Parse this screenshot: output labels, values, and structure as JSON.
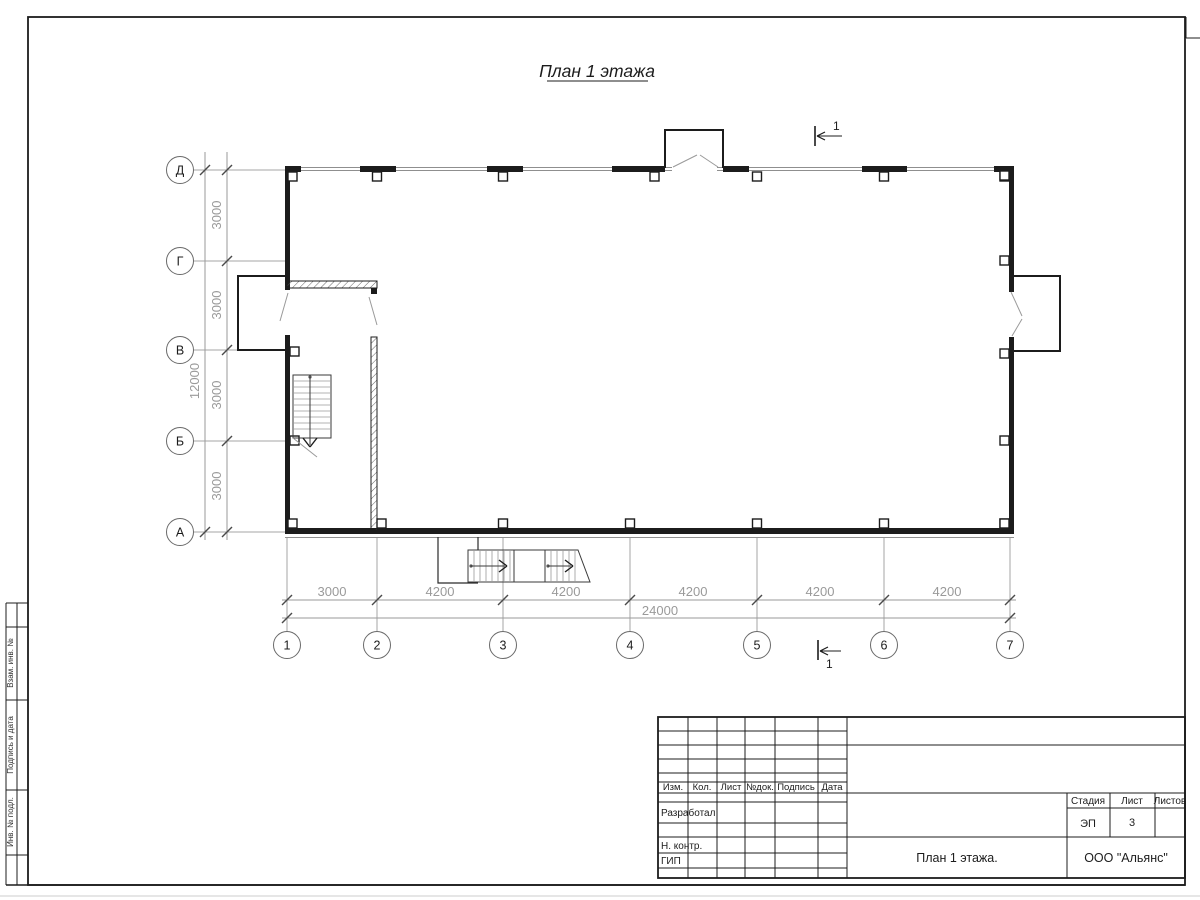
{
  "page": {
    "title_text": "План 1 этажа"
  },
  "axes": {
    "rows": [
      {
        "label": "Д"
      },
      {
        "label": "Г"
      },
      {
        "label": "В"
      },
      {
        "label": "Б"
      },
      {
        "label": "А"
      }
    ],
    "cols": [
      {
        "label": "1"
      },
      {
        "label": "2"
      },
      {
        "label": "3"
      },
      {
        "label": "4"
      },
      {
        "label": "5"
      },
      {
        "label": "6"
      },
      {
        "label": "7"
      }
    ]
  },
  "dims": {
    "bottom_segments": [
      "3000",
      "4200",
      "4200",
      "4200",
      "4200",
      "4200"
    ],
    "bottom_total": "24000",
    "left_segments": [
      "3000",
      "3000",
      "3000",
      "3000"
    ],
    "left_total": "12000"
  },
  "sections": {
    "top": "1",
    "bottom": "1"
  },
  "title_block": {
    "cols": [
      "Изм.",
      "Кол.",
      "Лист",
      "№док.",
      "Подпись",
      "Дата"
    ],
    "rows": [
      "Разработал",
      "Н. контр.",
      "ГИП"
    ],
    "stage_label": "Стадия",
    "sheet_label": "Лист",
    "sheets_label": "Листов",
    "stage_value": "ЭП",
    "sheet_value": "3",
    "sheets_value": "",
    "doc_title": "План 1 этажа.",
    "company": "ООО \"Альянс\""
  },
  "margin_boxes": [
    "Взам. инв. №",
    "Подпись и дата",
    "Инв. № подл."
  ],
  "colors": {
    "line": "#1c1c1c",
    "dimension": "#9a9a9a",
    "light": "#a6a6a6"
  }
}
